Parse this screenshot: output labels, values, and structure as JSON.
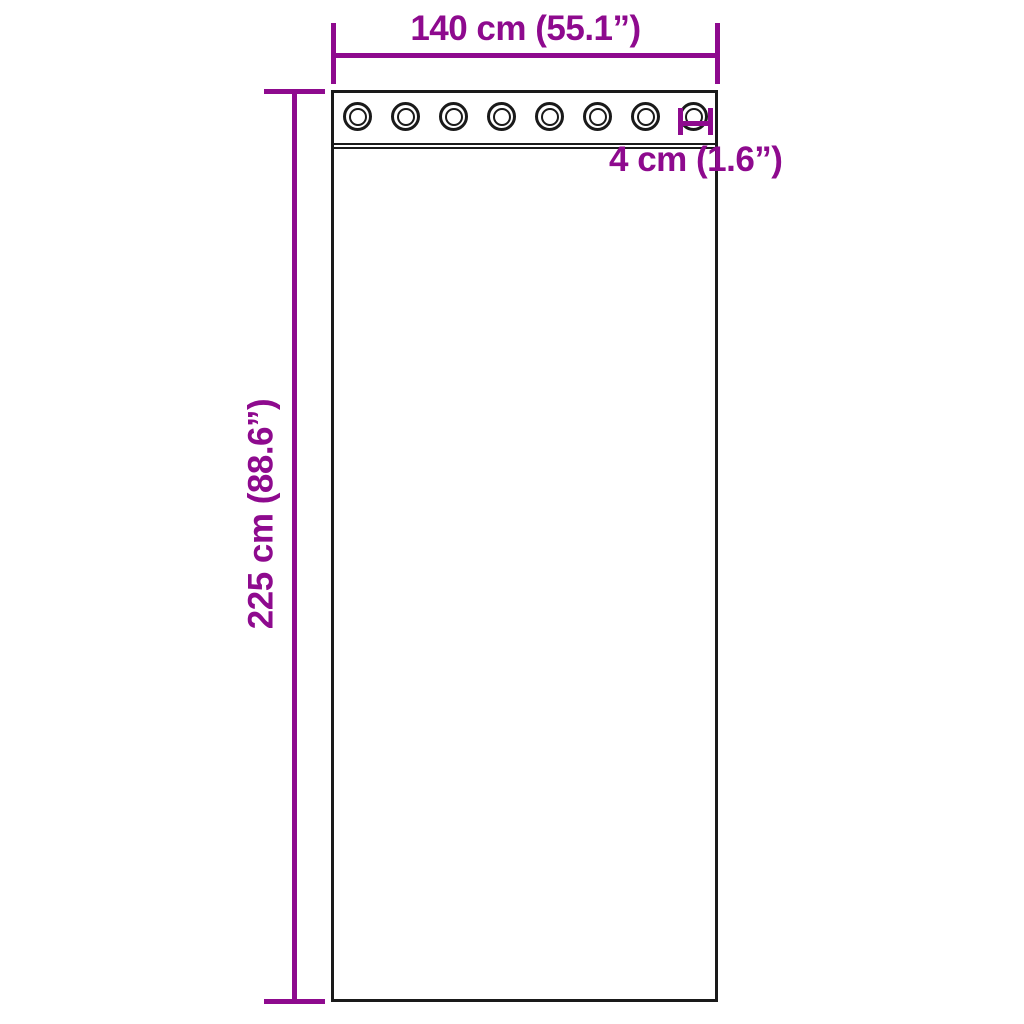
{
  "canvas": {
    "background": "#ffffff"
  },
  "colors": {
    "dimension_accent": "#8E0A8E",
    "outline": "#1a1a1a"
  },
  "curtain": {
    "grommet_count": 8
  },
  "dimensions": {
    "width": {
      "label": "140 cm (55.1”)"
    },
    "height": {
      "label": "225 cm (88.6”)"
    },
    "grommet_diameter": {
      "label": "4 cm (1.6”)"
    }
  }
}
